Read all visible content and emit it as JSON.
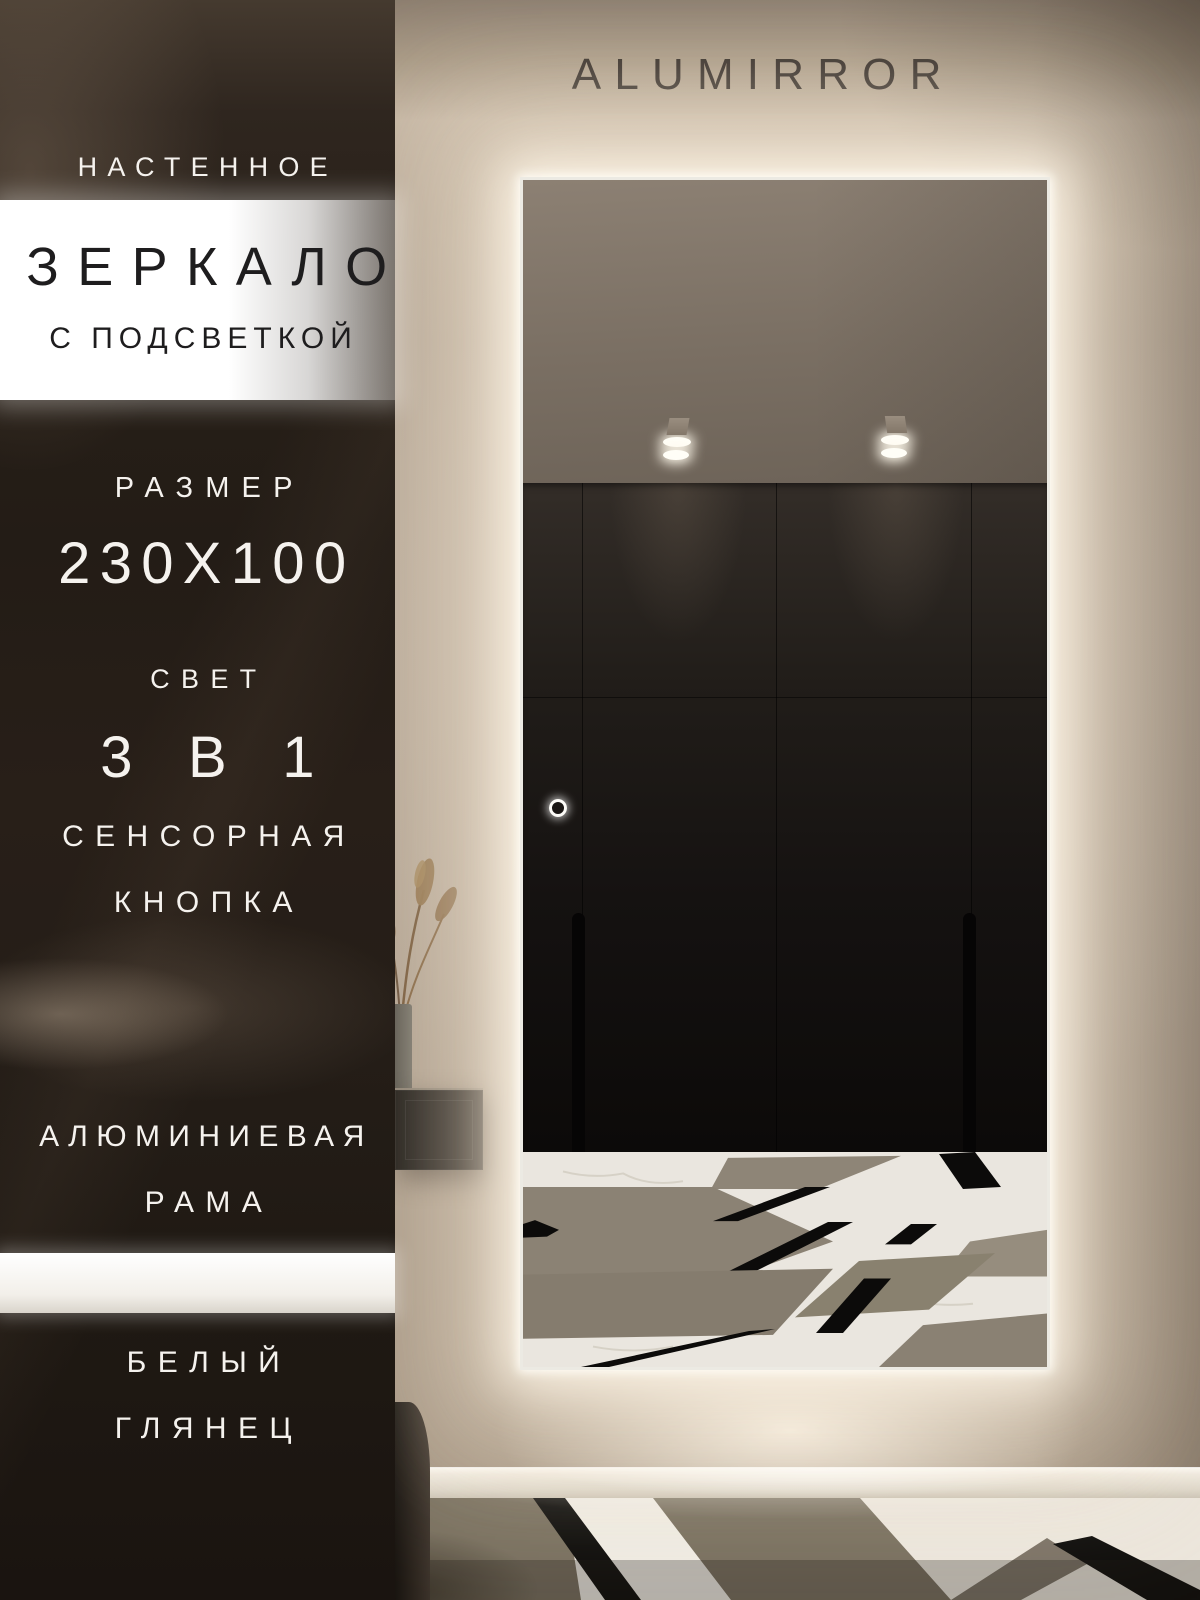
{
  "brand": {
    "name": "ALUMIRROR"
  },
  "panel": {
    "wall_mounted": "НАСТЕННОЕ",
    "product": "ЗЕРКАЛО",
    "with_backlight": "С ПОДСВЕТКОЙ",
    "size_label": "РАЗМЕР",
    "size_value": "230X100",
    "light_label": "СВЕТ",
    "light_value": "3 В 1",
    "touch_line1": "СЕНСОРНАЯ",
    "touch_line2": "КНОПКА",
    "frame_line1": "АЛЮМИНИЕВАЯ",
    "frame_line2": "РАМА",
    "finish_line1": "БЕЛЫЙ",
    "finish_line2": "ГЛЯНЕЦ"
  },
  "colors": {
    "led_glow": "#FFF6E8",
    "wall_beige": "#B3A493",
    "panel_dark": "#241D17",
    "text_light": "#F5F2EE",
    "text_dark": "#1E1D1E",
    "mirror_frame": "#ECEAE3"
  }
}
